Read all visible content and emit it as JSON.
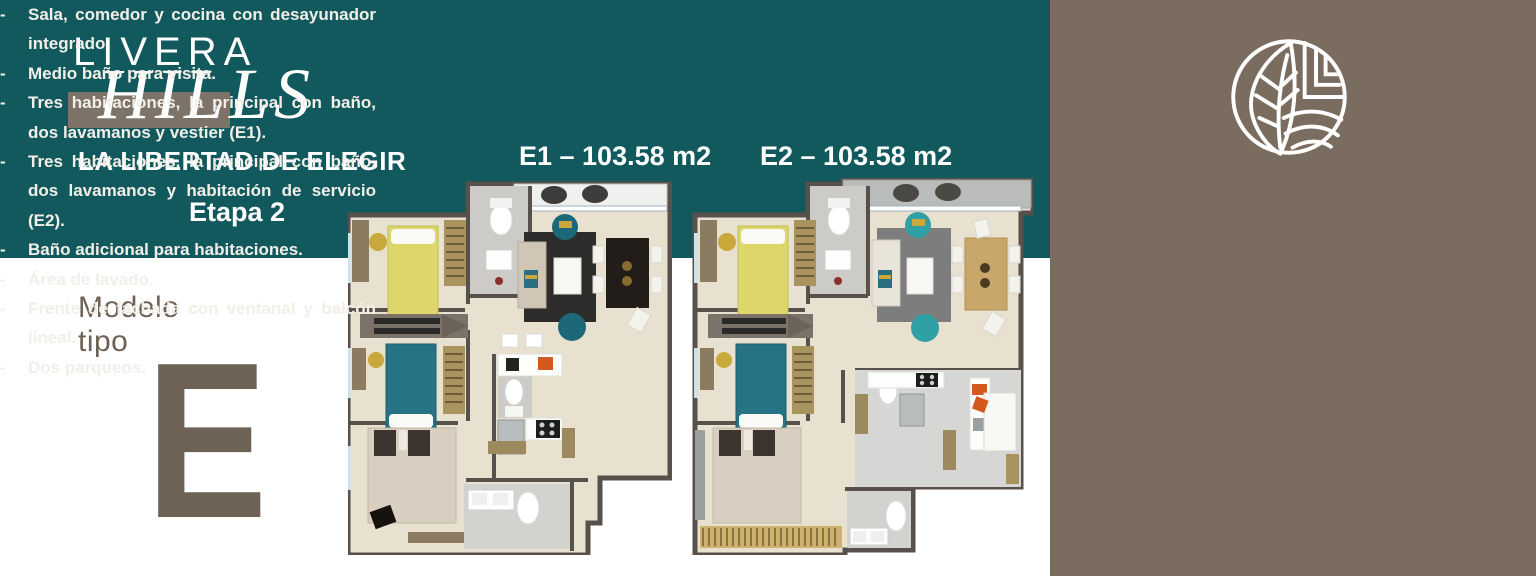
{
  "brand": {
    "name_top": "LIVERA",
    "name_script": "HILLS",
    "tagline": "LA LIBERTAD DE ELEGIR",
    "stage": "Etapa 2"
  },
  "model": {
    "caption_line1": "Modelo",
    "caption_line2": "tipo",
    "letter": "E"
  },
  "plans": [
    {
      "id": "E1",
      "label": "E1 – 103.58 m2",
      "area_m2": "103.58"
    },
    {
      "id": "E2",
      "label": "E2 – 103.58 m2",
      "area_m2": "103.58"
    }
  ],
  "features": {
    "bullet": "-",
    "items": [
      "Sala, comedor y cocina con desayunador integrado.",
      "Medio baño para visita.",
      "Tres habitaciones, la principal con baño, dos lavamanos y vestier (E1).",
      "Tres habitaciones, la principal con baño, dos lavamanos y habitación de servicio (E2).",
      "Baño adicional para habitaciones.",
      "Área de lavado.",
      "Frente de fachada con ventanal y balcón lineal.",
      "Dos parqueos."
    ]
  },
  "icons": {
    "logo": "leaf-circle-logo"
  },
  "colors": {
    "teal": "#12595e",
    "panel_brown": "#7b6c60",
    "accent_taupe": "#7d7368",
    "model_brown": "#6e6155",
    "text_light": "#f2efe9"
  }
}
